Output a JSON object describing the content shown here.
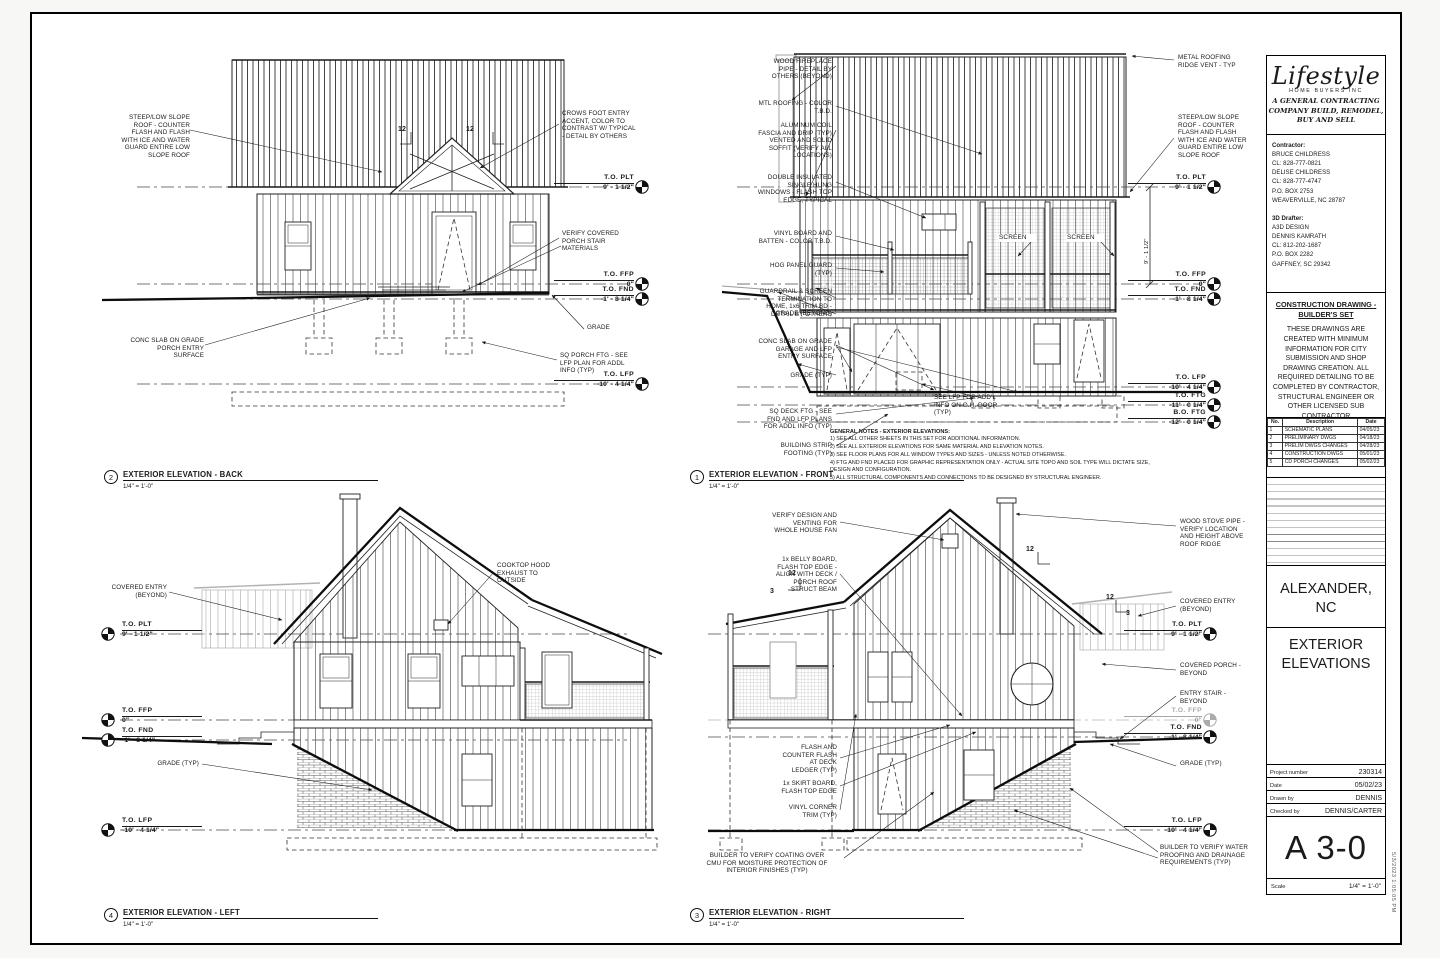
{
  "titleblock": {
    "logo": {
      "brand": "Lifestyle",
      "sub": "HOME BUYERS INC",
      "tagline": "A GENERAL CONTRACTING COMPANY BUILD, REMODEL, BUY AND SELL"
    },
    "contractor_heading": "Contractor:",
    "contractor_lines": [
      "BRUCE CHILDRESS",
      "CL: 828-777-0821",
      "DELISE CHILDRESS",
      "CL: 828-777-4747",
      "P.O. BOX 2753",
      "WEAVERVILLE, NC 28787"
    ],
    "drafter_heading": "3D Drafter:",
    "drafter_lines": [
      "A3D DESIGN",
      "DENNIS KAMRATH",
      "CL: 812-202-1687",
      "P.O. BOX 2282",
      "GAFFNEY, SC 29342"
    ],
    "notice_title": "CONSTRUCTION DRAWING - BUILDER'S SET",
    "notice_body": "THESE DRAWINGS ARE CREATED WITH MINIMUM INFORMATION FOR CITY SUBMISSION AND SHOP DRAWING CREATION. ALL REQUIRED DETAILING TO BE COMPLETED BY CONTRACTOR, STRUCTURAL ENGINEER OR OTHER LICENSED SUB CONTRACTOR",
    "revisions": {
      "headers": [
        "No.",
        "Description",
        "Date"
      ],
      "rows": [
        [
          "1",
          "SCHEMATIC PLANS",
          "04/05/23"
        ],
        [
          "2",
          "PRELIMINARY DWGS",
          "04/18/23"
        ],
        [
          "3",
          "PRELIM DWGS CHANGES",
          "04/28/23"
        ],
        [
          "4",
          "CONSTRUCTION DWGS",
          "05/01/23"
        ],
        [
          "5",
          "CD PORCH CHANGES",
          "05/02/23"
        ]
      ]
    },
    "location": "ALEXANDER, NC",
    "sheet_title": "EXTERIOR ELEVATIONS",
    "fields": [
      {
        "label": "Project number",
        "value": "230314"
      },
      {
        "label": "Date",
        "value": "05/02/23"
      },
      {
        "label": "Drawn by",
        "value": "DENNIS"
      },
      {
        "label": "Checked by",
        "value": "DENNIS/CARTER"
      }
    ],
    "sheet_number": "A 3-0",
    "scale_label": "Scale",
    "scale_value": "1/4\" = 1'-0\"",
    "plot_stamp": "5/3/2023 1:05:05 PM"
  },
  "general_notes": {
    "title": "GENERAL NOTES - EXTERIOR ELEVATIONS:",
    "items": [
      "1) SEE ALL OTHER SHEETS IN THIS SET FOR ADDITIONAL INFORMATION.",
      "2) SEE ALL EXTERIOR ELEVATIONS FOR SAME MATERIAL AND ELEVATION NOTES.",
      "3) SEE FLOOR PLANS FOR ALL WINDOW TYPES AND SIZES - UNLESS NOTED OTHERWISE.",
      "4) FTG AND FND PLACED FOR GRAPHIC REPRESENTATION ONLY - ACTUAL SITE TOPO AND SOIL TYPE WILL DICTATE SIZE, DESIGN AND CONFIGURATION.",
      "5) ALL STRUCTURAL COMPONENTS AND CONNECTIONS TO BE DESIGNED BY STRUCTURAL ENGINEER."
    ]
  },
  "elevations": {
    "back": {
      "number": "2",
      "title": "EXTERIOR ELEVATION - BACK",
      "scale": "1/4\" = 1'-0\"",
      "callouts": [
        {
          "name": "note-steep-low-slope-roof",
          "x": 20,
          "y": 72,
          "w": 128,
          "align": "right",
          "lines": [
            "STEEP/LOW SLOPE",
            "ROOF - COUNTER",
            "FLASH AND FLASH",
            "WITH ICE AND WATER",
            "GUARD ENTIRE LOW",
            "SLOPE ROOF"
          ]
        },
        {
          "name": "note-crows-foot",
          "x": 520,
          "y": 68,
          "w": 112,
          "align": "left",
          "lines": [
            "CROWS FOOT ENTRY",
            "ACCENT, COLOR TO",
            "CONTRAST W/ TYPICAL",
            "- DETAIL BY OTHERS"
          ]
        },
        {
          "name": "note-porch-stair",
          "x": 520,
          "y": 188,
          "w": 100,
          "align": "left",
          "lines": [
            "VERIFY COVERED",
            "PORCH STAIR",
            "MATERIALS"
          ]
        },
        {
          "name": "note-conc-slab",
          "x": 30,
          "y": 295,
          "w": 132,
          "align": "right",
          "lines": [
            "CONC SLAB ON GRADE",
            "PORCH ENTRY",
            "SURFACE"
          ]
        },
        {
          "name": "note-grade",
          "x": 545,
          "y": 282,
          "w": 60,
          "align": "left",
          "lines": [
            "GRADE"
          ]
        },
        {
          "name": "note-sq-porch-ftg",
          "x": 518,
          "y": 310,
          "w": 108,
          "align": "left",
          "lines": [
            "SQ PORCH FTG - SEE",
            "LFP PLAN FOR ADDL",
            "INFO (TYP)"
          ]
        },
        {
          "name": "level-to-plt",
          "cls": "level",
          "x": 512,
          "y": 132,
          "w": 80,
          "align": "right",
          "lines": [
            "T.O. PLT",
            "9' - 1 1/2\""
          ]
        },
        {
          "name": "level-to-ffp",
          "cls": "level",
          "x": 512,
          "y": 229,
          "w": 80,
          "align": "right",
          "lines": [
            "T.O. FFP",
            "0\""
          ]
        },
        {
          "name": "level-to-fnd",
          "cls": "level",
          "x": 512,
          "y": 244,
          "w": 80,
          "align": "right",
          "lines": [
            "T.O. FND",
            "-1' - 8 1/4\""
          ]
        },
        {
          "name": "level-to-lfp",
          "cls": "level",
          "x": 512,
          "y": 329,
          "w": 80,
          "align": "right",
          "lines": [
            "T.O. LFP",
            "-10' - 4 1/4\""
          ]
        },
        {
          "name": "slope-12",
          "cls": "slope",
          "x": 344,
          "y": 84,
          "w": 20,
          "align": "right",
          "lines": [
            "12"
          ]
        },
        {
          "name": "slope-12",
          "cls": "slope",
          "x": 424,
          "y": 84,
          "w": 20,
          "align": "left",
          "lines": [
            "12"
          ]
        }
      ]
    },
    "front": {
      "number": "1",
      "title": "EXTERIOR ELEVATION - FRONT",
      "scale": "1/4\" = 1'-0\"",
      "callouts": [
        {
          "name": "note-fireplace-pipe",
          "x": 40,
          "y": 16,
          "w": 110,
          "align": "right",
          "lines": [
            "WOOD FIREPLACE",
            "PIPE - DETAIL BY",
            "OTHERS (BEYOND)"
          ]
        },
        {
          "name": "note-mtl-roofing",
          "x": 40,
          "y": 58,
          "w": 110,
          "align": "right",
          "lines": [
            "MTL ROOFING - COLOR",
            "T.B.D."
          ]
        },
        {
          "name": "note-alum-coil",
          "x": 40,
          "y": 80,
          "w": 110,
          "align": "right",
          "lines": [
            "ALUMINUM COIL",
            "FASCIA AND DRIP (TYP)",
            "VENTED AND SOLID",
            "SOFFIT (VERIFY ALL",
            "LOCATIONS)"
          ]
        },
        {
          "name": "note-windows",
          "x": 40,
          "y": 132,
          "w": 110,
          "align": "right",
          "lines": [
            "DOUBLE INSULATED",
            "SINGLE HUNG",
            "WINDOWS - FLASH TOP",
            "EDGE, TYPICAL"
          ]
        },
        {
          "name": "note-vinyl-bb",
          "x": 40,
          "y": 188,
          "w": 110,
          "align": "right",
          "lines": [
            "VINYL BOARD AND",
            "BATTEN - COLOR T.B.D."
          ]
        },
        {
          "name": "note-hog-panel",
          "x": 40,
          "y": 220,
          "w": 110,
          "align": "right",
          "lines": [
            "HOG PANEL GUARD",
            "(TYP)"
          ]
        },
        {
          "name": "note-guardrail",
          "x": 40,
          "y": 246,
          "w": 110,
          "align": "right",
          "lines": [
            "GUARDRAIL & SCREEN",
            "TERMINATION TO",
            "HOME, 1x6 TRIM BD -",
            "DETAIL BY OTHERS"
          ]
        },
        {
          "name": "note-grade-beyond",
          "x": 40,
          "y": 268,
          "w": 110,
          "align": "right",
          "lines": [
            "GRADE (BEYOND)"
          ]
        },
        {
          "name": "note-conc-slab-garage",
          "x": 40,
          "y": 296,
          "w": 110,
          "align": "right",
          "lines": [
            "CONC SLAB ON GRADE",
            "GARAGE AND LFP",
            "ENTRY SURFACE"
          ]
        },
        {
          "name": "note-grade-typ",
          "x": 40,
          "y": 330,
          "w": 110,
          "align": "right",
          "lines": [
            "GRADE (TYP)"
          ]
        },
        {
          "name": "note-sq-deck-ftg",
          "x": 40,
          "y": 366,
          "w": 110,
          "align": "right",
          "lines": [
            "SQ DECK FTG - SEE",
            "FND AND LFP PLANS",
            "FOR ADDL INFO (TYP)"
          ]
        },
        {
          "name": "note-strip-footing",
          "x": 40,
          "y": 400,
          "w": 110,
          "align": "right",
          "lines": [
            "BUILDING STRIP",
            "FOOTING (TYP)"
          ]
        },
        {
          "name": "note-ridge-vent",
          "x": 496,
          "y": 12,
          "w": 76,
          "align": "left",
          "lines": [
            "METAL ROOFING",
            "RIDGE VENT - TYP"
          ]
        },
        {
          "name": "note-steep-low-slope-roof",
          "x": 496,
          "y": 72,
          "w": 76,
          "align": "left",
          "lines": [
            "STEEP/LOW SLOPE",
            "ROOF - COUNTER",
            "FLASH AND FLASH",
            "WITH ICE AND WATER",
            "GUARD ENTIRE LOW",
            "SLOPE ROOF"
          ]
        },
        {
          "name": "label-screen",
          "cls": "screenlbl",
          "x": 316,
          "y": 192,
          "w": 38,
          "align": "left",
          "lines": [
            "SCREEN"
          ]
        },
        {
          "name": "label-screen",
          "cls": "screenlbl",
          "x": 384,
          "y": 192,
          "w": 38,
          "align": "left",
          "lines": [
            "SCREEN"
          ]
        },
        {
          "name": "note-see-lfp-door",
          "x": 252,
          "y": 352,
          "w": 88,
          "align": "left",
          "lines": [
            "SEE LFP FOR ADD'L",
            "INFO ON O.H. DOOR",
            "(TYP)"
          ]
        },
        {
          "name": "dim-9-1-1-2",
          "cls": "rot",
          "x": 462,
          "y": 222,
          "w": 40,
          "align": "left",
          "lines": [
            "9' - 1 1/2\""
          ]
        },
        {
          "name": "level-to-plt",
          "cls": "level",
          "x": 446,
          "y": 132,
          "w": 78,
          "align": "right",
          "lines": [
            "T.O. PLT",
            "9' - 1 1/2\""
          ]
        },
        {
          "name": "level-to-ffp",
          "cls": "level",
          "x": 446,
          "y": 229,
          "w": 78,
          "align": "right",
          "lines": [
            "T.O. FFP",
            "0\""
          ]
        },
        {
          "name": "level-to-fnd",
          "cls": "level",
          "x": 446,
          "y": 244,
          "w": 78,
          "align": "right",
          "lines": [
            "T.O. FND",
            "-1' - 8 1/4\""
          ]
        },
        {
          "name": "level-to-lfp",
          "cls": "level",
          "x": 446,
          "y": 332,
          "w": 78,
          "align": "right",
          "lines": [
            "T.O. LFP",
            "-10' - 4 1/4\""
          ]
        },
        {
          "name": "level-to-ftg",
          "cls": "level",
          "x": 446,
          "y": 350,
          "w": 78,
          "align": "right",
          "lines": [
            "T.O. FTG",
            "-11' - 0 1/4\""
          ]
        },
        {
          "name": "level-bo-ftg",
          "cls": "level",
          "x": 446,
          "y": 367,
          "w": 78,
          "align": "right",
          "lines": [
            "B.O. FTG",
            "-12' - 0 1/4\""
          ]
        }
      ]
    },
    "left": {
      "number": "4",
      "title": "EXTERIOR ELEVATION - LEFT",
      "scale": "1/4\" = 1'-0\"",
      "callouts": [
        {
          "name": "note-covered-entry",
          "x": 20,
          "y": 92,
          "w": 105,
          "align": "right",
          "lines": [
            "COVERED ENTRY",
            "(BEYOND)"
          ]
        },
        {
          "name": "note-cooktop-hood",
          "x": 455,
          "y": 70,
          "w": 95,
          "align": "left",
          "lines": [
            "COOKTOP HOOD",
            "EXHAUST TO",
            "OUTSIDE"
          ]
        },
        {
          "name": "note-grade-typ",
          "x": 85,
          "y": 268,
          "w": 72,
          "align": "right",
          "lines": [
            "GRADE (TYP)"
          ]
        },
        {
          "name": "level-to-plt",
          "cls": "level",
          "x": 80,
          "y": 129,
          "w": 80,
          "align": "left",
          "lines": [
            "T.O. PLT",
            "9' - 1 1/2\""
          ]
        },
        {
          "name": "level-to-ffp",
          "cls": "level",
          "x": 80,
          "y": 215,
          "w": 80,
          "align": "left",
          "lines": [
            "T.O. FFP",
            "0\""
          ]
        },
        {
          "name": "level-to-fnd",
          "cls": "level",
          "x": 80,
          "y": 235,
          "w": 80,
          "align": "left",
          "lines": [
            "T.O. FND",
            "-1' - 8 1/4\""
          ]
        },
        {
          "name": "level-to-lfp",
          "cls": "level",
          "x": 80,
          "y": 325,
          "w": 80,
          "align": "left",
          "lines": [
            "T.O. LFP",
            "-10' - 4 1/4\""
          ]
        }
      ]
    },
    "right": {
      "number": "3",
      "title": "EXTERIOR ELEVATION - RIGHT",
      "scale": "1/4\" = 1'-0\"",
      "callouts": [
        {
          "name": "note-whole-house-fan",
          "x": 35,
          "y": 20,
          "w": 120,
          "align": "right",
          "lines": [
            "VERIFY DESIGN AND",
            "VENTING FOR",
            "WHOLE HOUSE FAN"
          ]
        },
        {
          "name": "note-belly-board",
          "x": 35,
          "y": 64,
          "w": 120,
          "align": "right",
          "lines": [
            "1x BELLY BOARD,",
            "FLASH TOP EDGE -",
            "ALIGN WITH DECK /",
            "PORCH ROOF",
            "STRUCT BEAM"
          ]
        },
        {
          "name": "note-flash-ledger",
          "x": 60,
          "y": 252,
          "w": 95,
          "align": "right",
          "lines": [
            "FLASH AND",
            "COUNTER FLASH",
            "AT DECK",
            "LEDGER (TYP)"
          ]
        },
        {
          "name": "note-skirt-board",
          "x": 60,
          "y": 288,
          "w": 95,
          "align": "right",
          "lines": [
            "1x SKIRT BOARD,",
            "FLASH TOP EDGE"
          ]
        },
        {
          "name": "note-vinyl-corner",
          "x": 60,
          "y": 312,
          "w": 95,
          "align": "right",
          "lines": [
            "VINYL CORNER",
            "TRIM (TYP)"
          ]
        },
        {
          "name": "note-cmu-coating",
          "x": 10,
          "y": 360,
          "w": 150,
          "align": "center",
          "lines": [
            "BUILDER TO VERIFY COATING OVER",
            "CMU FOR MOISTURE PROTECTION OF",
            "INTERIOR FINISHES (TYP)"
          ]
        },
        {
          "name": "note-wood-stove-pipe",
          "x": 498,
          "y": 26,
          "w": 78,
          "align": "left",
          "lines": [
            "WOOD STOVE PIPE -",
            "VERIFY LOCATION",
            "AND HEIGHT ABOVE",
            "ROOF RIDGE"
          ]
        },
        {
          "name": "note-covered-entry",
          "x": 498,
          "y": 106,
          "w": 78,
          "align": "left",
          "lines": [
            "COVERED ENTRY",
            "(BEYOND)"
          ]
        },
        {
          "name": "note-covered-porch",
          "x": 498,
          "y": 170,
          "w": 78,
          "align": "left",
          "lines": [
            "COVERED PORCH -",
            "BEYOND"
          ]
        },
        {
          "name": "note-entry-stair",
          "x": 498,
          "y": 198,
          "w": 78,
          "align": "left",
          "lines": [
            "ENTRY STAIR -",
            "BEYOND"
          ]
        },
        {
          "name": "note-grade-typ",
          "x": 498,
          "y": 268,
          "w": 78,
          "align": "left",
          "lines": [
            "GRADE (TYP)"
          ]
        },
        {
          "name": "note-waterproofing",
          "x": 478,
          "y": 352,
          "w": 112,
          "align": "left",
          "lines": [
            "BUILDER TO VERIFY WATER",
            "PROOFING AND DRAINAGE",
            "REQUIREMENTS (TYP)"
          ]
        },
        {
          "name": "level-to-plt",
          "cls": "level",
          "x": 442,
          "y": 129,
          "w": 78,
          "align": "right",
          "lines": [
            "T.O. PLT",
            "9' - 1 1/2\""
          ]
        },
        {
          "name": "level-to-ffp",
          "cls": "level faint",
          "x": 442,
          "y": 215,
          "w": 78,
          "align": "right",
          "lines": [
            "T.O. FFP",
            "0\""
          ]
        },
        {
          "name": "level-to-fnd",
          "cls": "level",
          "x": 442,
          "y": 232,
          "w": 78,
          "align": "right",
          "lines": [
            "T.O. FND",
            "-1' - 8 1/4\""
          ]
        },
        {
          "name": "level-to-lfp",
          "cls": "level",
          "x": 442,
          "y": 325,
          "w": 78,
          "align": "right",
          "lines": [
            "T.O. LFP",
            "-10' - 4 1/4\""
          ]
        },
        {
          "name": "slope-12",
          "cls": "slope",
          "x": 106,
          "y": 78,
          "w": 18,
          "align": "left",
          "lines": [
            "12"
          ]
        },
        {
          "name": "slope-3",
          "cls": "slope",
          "x": 88,
          "y": 96,
          "w": 18,
          "align": "left",
          "lines": [
            "3"
          ]
        },
        {
          "name": "slope-12",
          "cls": "slope",
          "x": 344,
          "y": 54,
          "w": 18,
          "align": "left",
          "lines": [
            "12"
          ]
        },
        {
          "name": "slope-12",
          "cls": "slope",
          "x": 424,
          "y": 102,
          "w": 18,
          "align": "left",
          "lines": [
            "12"
          ]
        },
        {
          "name": "slope-3",
          "cls": "slope",
          "x": 444,
          "y": 118,
          "w": 18,
          "align": "left",
          "lines": [
            "3"
          ]
        }
      ]
    }
  }
}
